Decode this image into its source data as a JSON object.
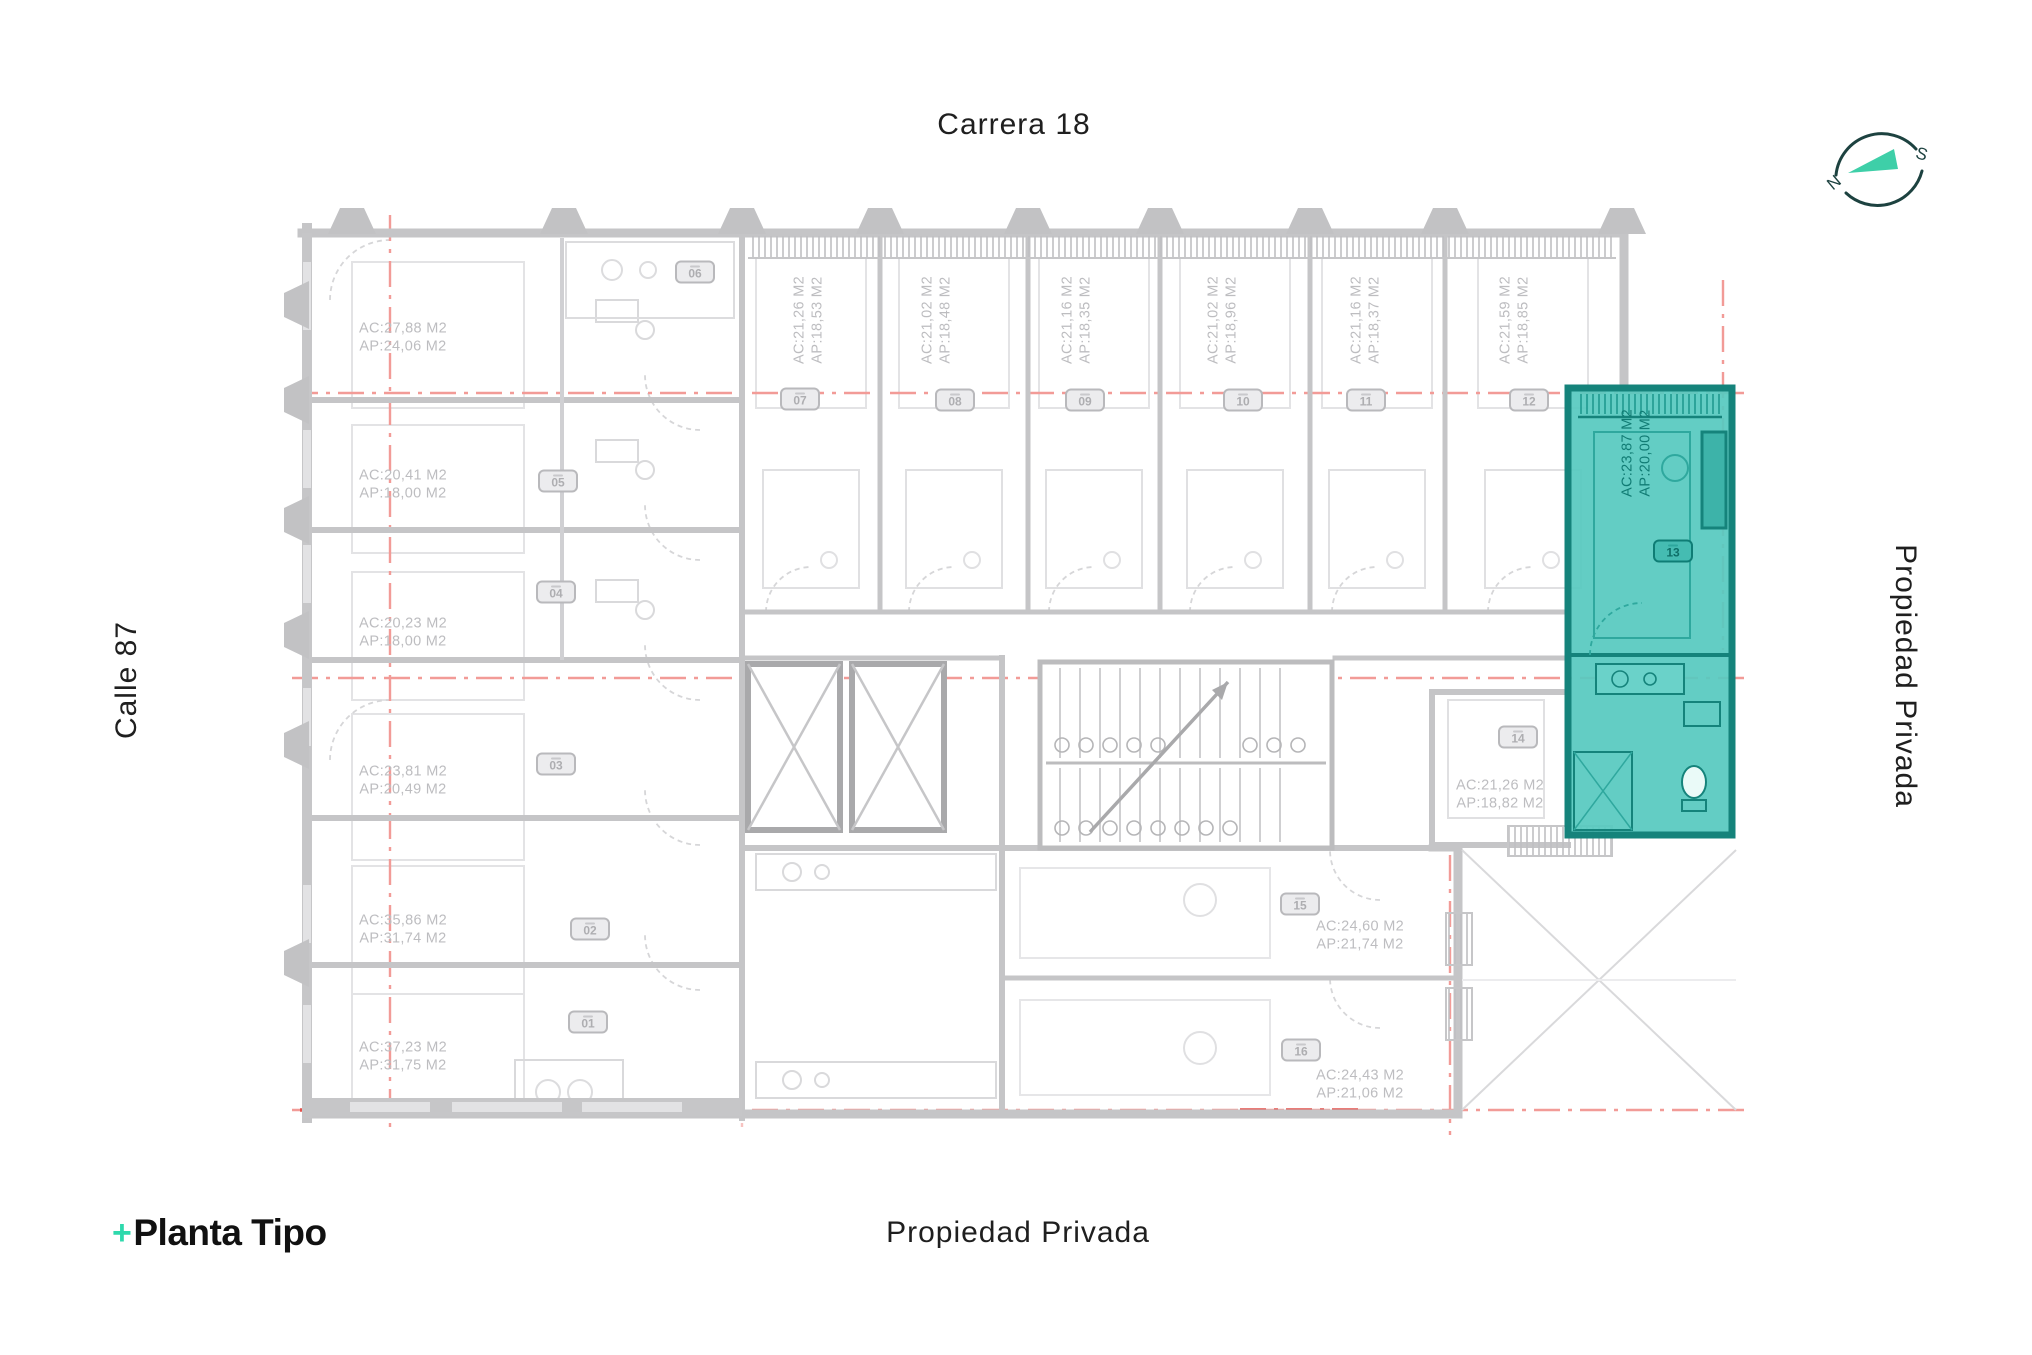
{
  "streets": {
    "top": "Carrera 18",
    "left": "Calle 87",
    "right": "Propiedad Privada",
    "bottom": "Propiedad Privada"
  },
  "logo": {
    "plus": "+",
    "name": "Planta Tipo"
  },
  "compass": {
    "west_letter": "N",
    "east_letter": "S"
  },
  "plan": {
    "title": "Planta Tipo",
    "highlighted_unit": "13",
    "colors": {
      "highlight_fill": "#57c9c0",
      "highlight_border": "#15837b",
      "axis_red": "#f29b97",
      "axis_red_dark": "#e2504b",
      "wall_gray": "#c5c5c7",
      "label_gray": "#bdbdc0",
      "logo_teal": "#2ed9ac",
      "compass_ink": "#1d4240"
    }
  },
  "units": [
    {
      "num": "01",
      "ac": "AC:37,23 M2",
      "ap": "AP:31,75 M2"
    },
    {
      "num": "02",
      "ac": "AC:35,86 M2",
      "ap": "AP:31,74 M2"
    },
    {
      "num": "03",
      "ac": "AC:23,81 M2",
      "ap": "AP:20,49 M2"
    },
    {
      "num": "04",
      "ac": "AC:20,23 M2",
      "ap": "AP:18,00 M2"
    },
    {
      "num": "05",
      "ac": "AC:20,41 M2",
      "ap": "AP:18,00 M2"
    },
    {
      "num": "06",
      "ac": "AC:27,88 M2",
      "ap": "AP:24,06 M2"
    },
    {
      "num": "07",
      "ac": "AC:21,26 M2",
      "ap": "AP:18,53 M2"
    },
    {
      "num": "08",
      "ac": "AC:21,02 M2",
      "ap": "AP:18,48 M2"
    },
    {
      "num": "09",
      "ac": "AC:21,16 M2",
      "ap": "AP:18,35 M2"
    },
    {
      "num": "10",
      "ac": "AC:21,02 M2",
      "ap": "AP:18,96 M2"
    },
    {
      "num": "11",
      "ac": "AC:21,16 M2",
      "ap": "AP:18,37 M2"
    },
    {
      "num": "12",
      "ac": "AC:21,59 M2",
      "ap": "AP:18,85 M2"
    },
    {
      "num": "13",
      "ac": "AC:23,87 M2",
      "ap": "AP:20,00 M2",
      "highlighted": true
    },
    {
      "num": "14",
      "ac": "AC:21,26 M2",
      "ap": "AP:18,82 M2"
    },
    {
      "num": "15",
      "ac": "AC:24,60 M2",
      "ap": "AP:21,74 M2"
    },
    {
      "num": "16",
      "ac": "AC:24,43 M2",
      "ap": "AP:21,06 M2"
    }
  ]
}
